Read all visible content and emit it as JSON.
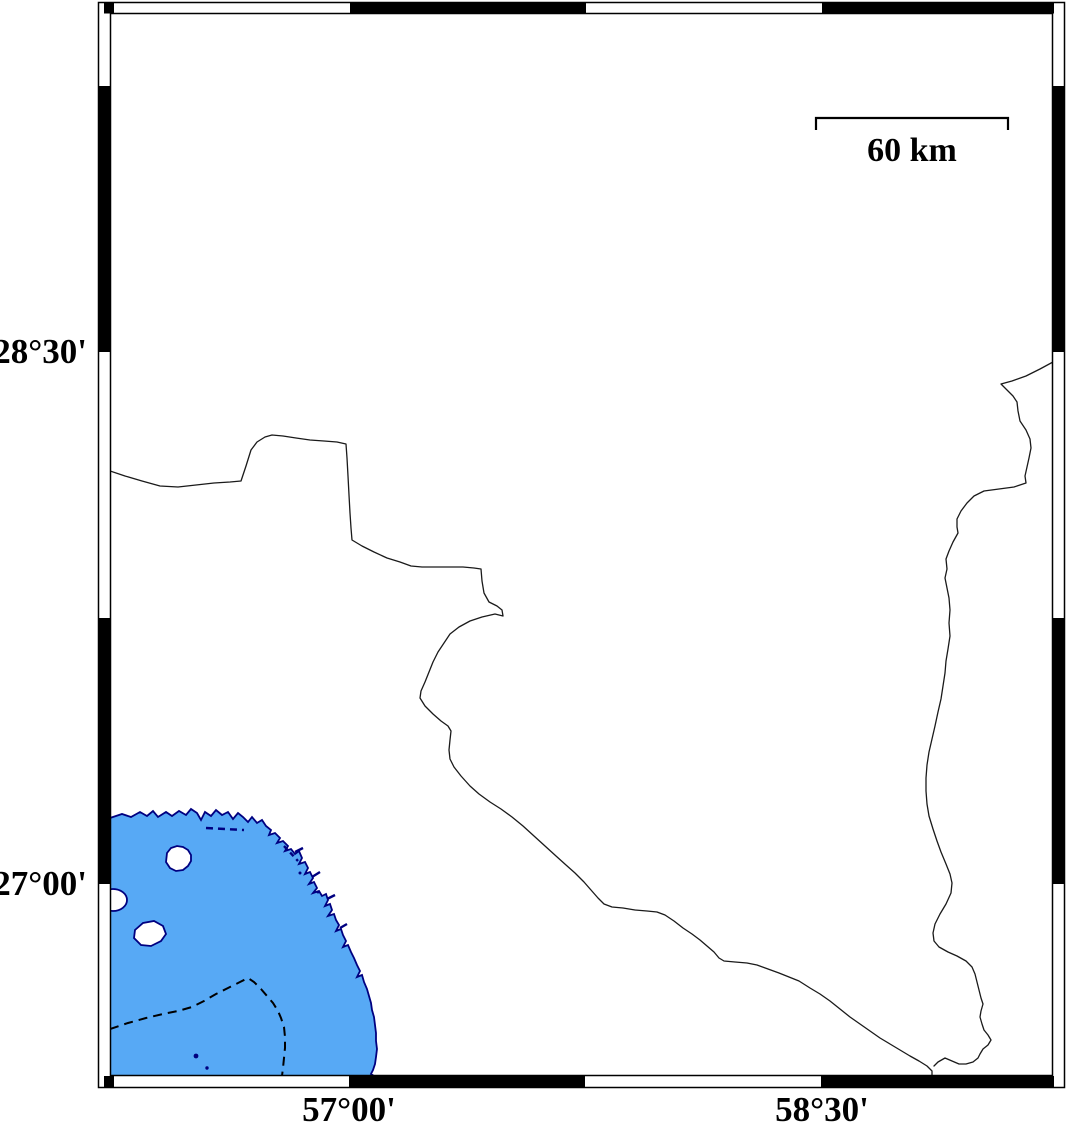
{
  "map_figure": {
    "frame_labels": {
      "lat_upper": "28°30'",
      "lat_lower": "27°00'",
      "lon_left": "57°00'",
      "lon_right": "58°30'"
    },
    "scale_bar": {
      "label": "60 km"
    },
    "colors": {
      "sea_fill": "#57a9f5",
      "coastline": "#000080",
      "frame": "#000000",
      "boundary_line": "#1a1a1a"
    }
  }
}
